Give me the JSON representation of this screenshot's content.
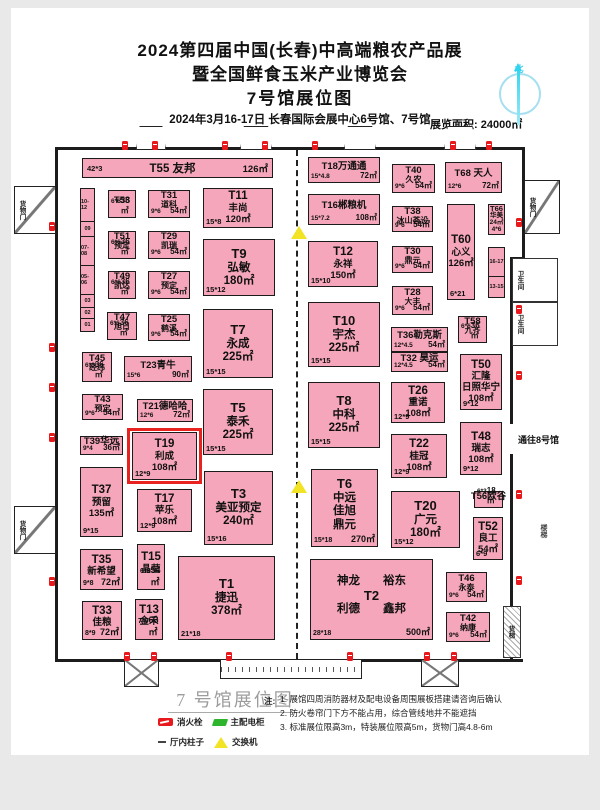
{
  "header": {
    "title1": "2024第四届中国(长春)中高端粮农产品展",
    "title2": "暨全国鲜食玉米产业博览会",
    "title3": "7号馆展位图",
    "date_line": "2024年3月16-17日  长春国际会展中心6号馆、7号馆",
    "area_label": "展览面积: 24000㎡"
  },
  "compass": {
    "north": "北"
  },
  "map": {
    "gate8": {
      "text": "通往8号馆",
      "x": 518,
      "y": 433
    },
    "side_label": {
      "text": "楼梯",
      "x": 538,
      "y": 524
    },
    "elevator": {
      "label": "货梯",
      "rect": [
        503,
        606,
        18,
        52
      ]
    },
    "booths": [
      {
        "id": "T55",
        "bar": true,
        "lines": [
          "T55  友邦"
        ],
        "bl": "42*3",
        "br": "126㎡",
        "rect": [
          82,
          158,
          191,
          20
        ]
      },
      {
        "id": "T53",
        "lines": [
          "T53"
        ],
        "bl": "6*6",
        "br": "36㎡",
        "rect": [
          108,
          190,
          28,
          28
        ]
      },
      {
        "id": "T31",
        "lines": [
          "T31",
          "道科"
        ],
        "bl": "9*6",
        "br": "54㎡",
        "rect": [
          148,
          190,
          42,
          28
        ]
      },
      {
        "id": "T11",
        "lines": [
          "T11",
          "丰尚",
          "120㎡"
        ],
        "bl": "15*8",
        "rect": [
          203,
          188,
          70,
          40
        ]
      },
      {
        "id": "T51",
        "lines": [
          "T51",
          "预定"
        ],
        "bl": "6*6",
        "br": "36㎡",
        "rect": [
          108,
          231,
          28,
          28
        ]
      },
      {
        "id": "T29",
        "lines": [
          "T29",
          "凯瑞"
        ],
        "bl": "9*6",
        "br": "54㎡",
        "rect": [
          148,
          231,
          42,
          28
        ]
      },
      {
        "id": "T9",
        "lines": [
          "T9",
          "弘敏",
          "180㎡"
        ],
        "bl": "15*12",
        "rect": [
          203,
          239,
          72,
          57
        ]
      },
      {
        "id": "T49",
        "lines": [
          "T49",
          "凯达"
        ],
        "bl": "6*6",
        "br": "36㎡",
        "rect": [
          108,
          271,
          28,
          28
        ]
      },
      {
        "id": "T27",
        "lines": [
          "T27",
          "预定"
        ],
        "bl": "9*6",
        "br": "54㎡",
        "rect": [
          148,
          271,
          42,
          28
        ]
      },
      {
        "id": "T47",
        "lines": [
          "T47",
          "旭日"
        ],
        "bl": "6*6",
        "br": "36㎡",
        "rect": [
          107,
          312,
          30,
          28
        ]
      },
      {
        "id": "T25",
        "lines": [
          "T25",
          "鹤溪"
        ],
        "bl": "9*6",
        "br": "54㎡",
        "rect": [
          148,
          314,
          42,
          27
        ]
      },
      {
        "id": "T7",
        "lines": [
          "T7",
          "永成",
          "225㎡"
        ],
        "bl": "15*15",
        "rect": [
          203,
          309,
          70,
          69
        ]
      },
      {
        "id": "T45",
        "lines": [
          "T45",
          "经纬"
        ],
        "bl": "6*6",
        "br": "36㎡",
        "rect": [
          82,
          352,
          30,
          30
        ]
      },
      {
        "id": "T23",
        "lines": [
          "T23青牛"
        ],
        "bl": "15*6",
        "br": "90㎡",
        "rect": [
          124,
          356,
          68,
          26
        ]
      },
      {
        "id": "T43",
        "lines": [
          "T43",
          "预定"
        ],
        "bl": "9*6",
        "br": "54㎡",
        "rect": [
          82,
          394,
          41,
          26
        ]
      },
      {
        "id": "T21",
        "lines": [
          "T21德哈哈"
        ],
        "bl": "12*6",
        "br": "72㎡",
        "rect": [
          137,
          399,
          56,
          23
        ]
      },
      {
        "id": "T5",
        "lines": [
          "T5",
          "泰禾",
          "225㎡"
        ],
        "bl": "15*15",
        "rect": [
          203,
          389,
          70,
          66
        ]
      },
      {
        "id": "T39",
        "lines": [
          "T39华远"
        ],
        "bl": "9*4",
        "br": "36㎡",
        "rect": [
          80,
          436,
          43,
          19
        ]
      },
      {
        "id": "T19",
        "hl": true,
        "lines": [
          "T19",
          "利成",
          "108㎡"
        ],
        "bl": "12*9",
        "rect": [
          132,
          432,
          65,
          48
        ]
      },
      {
        "id": "T37",
        "lines": [
          "T37",
          "预留",
          "135㎡"
        ],
        "bl": "9*15",
        "rect": [
          80,
          467,
          43,
          70
        ]
      },
      {
        "id": "T17",
        "lines": [
          "T17",
          "苹乐",
          "108㎡"
        ],
        "bl": "12*9",
        "rect": [
          137,
          489,
          55,
          43
        ]
      },
      {
        "id": "T3",
        "lines": [
          "T3",
          "美亚预定",
          "240㎡"
        ],
        "bl": "15*16",
        "rect": [
          204,
          471,
          69,
          74
        ]
      },
      {
        "id": "T35",
        "lines": [
          "T35",
          "新希望"
        ],
        "bl": "9*8",
        "br": "72㎡",
        "rect": [
          80,
          549,
          43,
          41
        ]
      },
      {
        "id": "T15",
        "lines": [
          "T15",
          "晶莹"
        ],
        "bl": "6*9",
        "br": "54㎡",
        "rect": [
          137,
          544,
          28,
          46
        ]
      },
      {
        "id": "T1",
        "lines": [
          "T1",
          "捷迅",
          "378㎡"
        ],
        "bl": "21*18",
        "rect": [
          178,
          556,
          97,
          84
        ]
      },
      {
        "id": "T33",
        "lines": [
          "T33",
          "佳粮"
        ],
        "bl": "8*9",
        "br": "72㎡",
        "rect": [
          82,
          601,
          40,
          39
        ]
      },
      {
        "id": "T13",
        "lines": [
          "T13",
          "金禾"
        ],
        "bl": "7*9",
        "br": "63㎡",
        "rect": [
          135,
          599,
          28,
          41
        ]
      },
      {
        "id": "T18",
        "lines": [
          "T18万通通"
        ],
        "bl": "15*4.8",
        "br": "72㎡",
        "rect": [
          308,
          157,
          72,
          26
        ]
      },
      {
        "id": "T40",
        "lines": [
          "T40",
          "久农"
        ],
        "bl": "9*6",
        "br": "54㎡",
        "rect": [
          392,
          164,
          43,
          29
        ]
      },
      {
        "id": "T68",
        "lines": [
          "T68 天人"
        ],
        "bl": "12*6",
        "br": "72㎡",
        "rect": [
          445,
          162,
          57,
          31
        ]
      },
      {
        "id": "T16",
        "lines": [
          "T16郴粮机"
        ],
        "bl": "15*7.2",
        "br": "108㎡",
        "rect": [
          308,
          194,
          72,
          31
        ]
      },
      {
        "id": "T38",
        "lines": [
          "T38",
          "冰山荟设"
        ],
        "bl": "9*6",
        "br": "54㎡",
        "rect": [
          392,
          206,
          41,
          26
        ]
      },
      {
        "id": "T66",
        "lines": [
          "T66",
          "华美",
          "24㎡",
          "4*6"
        ],
        "rect": [
          488,
          204,
          17,
          31
        ]
      },
      {
        "id": "T12",
        "lines": [
          "T12",
          "永祥",
          "150㎡"
        ],
        "bl": "15*10",
        "rect": [
          308,
          241,
          70,
          46
        ]
      },
      {
        "id": "T30",
        "lines": [
          "T30",
          "鼎元"
        ],
        "bl": "9*6",
        "br": "54㎡",
        "rect": [
          392,
          246,
          41,
          27
        ]
      },
      {
        "id": "T60",
        "lines": [
          "T60",
          "心义",
          "126㎡"
        ],
        "bl": "6*21",
        "rect": [
          447,
          204,
          28,
          96
        ]
      },
      {
        "id": "T28",
        "lines": [
          "T28",
          "大丰"
        ],
        "bl": "9*6",
        "br": "54㎡",
        "rect": [
          392,
          286,
          41,
          29
        ]
      },
      {
        "id": "T10",
        "lines": [
          "T10",
          "宇杰",
          "225㎡"
        ],
        "bl": "15*15",
        "rect": [
          308,
          302,
          72,
          65
        ]
      },
      {
        "id": "T36",
        "lines": [
          "T36勒克斯"
        ],
        "bl": "12*4.5",
        "br": "54㎡",
        "rect": [
          391,
          327,
          57,
          25
        ]
      },
      {
        "id": "T32",
        "lines": [
          "T32 昊运"
        ],
        "bl": "12*4.5",
        "br": "54㎡",
        "rect": [
          391,
          352,
          57,
          20
        ]
      },
      {
        "id": "T58",
        "lines": [
          "T58",
          "九齐"
        ],
        "bl": "6*6",
        "br": "36㎡",
        "rect": [
          458,
          316,
          29,
          27
        ]
      },
      {
        "id": "T50",
        "lines": [
          "T50",
          "汇隆",
          "日照华宁",
          "108㎡"
        ],
        "bl": "9*12",
        "rect": [
          460,
          354,
          42,
          56
        ]
      },
      {
        "id": "T26",
        "lines": [
          "T26",
          "重诺",
          "108㎡"
        ],
        "bl": "12*9",
        "rect": [
          391,
          382,
          54,
          41
        ]
      },
      {
        "id": "T8",
        "lines": [
          "T8",
          "中科",
          "225㎡"
        ],
        "bl": "15*15",
        "rect": [
          308,
          382,
          72,
          66
        ]
      },
      {
        "id": "T22",
        "lines": [
          "T22",
          "桂冠",
          "108㎡"
        ],
        "bl": "12*9",
        "rect": [
          391,
          434,
          56,
          44
        ]
      },
      {
        "id": "T48",
        "lines": [
          "T48",
          "瑞志",
          "108㎡"
        ],
        "bl": "9*12",
        "rect": [
          460,
          422,
          42,
          53
        ]
      },
      {
        "id": "T6",
        "lines": [
          "T6",
          "中远",
          "佳旭",
          "鼎元"
        ],
        "bl": "15*18",
        "br": "270㎡",
        "rect": [
          311,
          469,
          67,
          78
        ]
      },
      {
        "id": "T20",
        "lines": [
          "T20",
          "广元",
          "180㎡"
        ],
        "bl": "15*12",
        "rect": [
          391,
          491,
          69,
          57
        ]
      },
      {
        "id": "T56",
        "lines": [
          "T56欧谷"
        ],
        "bl": "6*3",
        "br": "18㎡",
        "rect": [
          474,
          491,
          29,
          17
        ]
      },
      {
        "id": "T52",
        "lines": [
          "T52",
          "良工",
          "54㎡"
        ],
        "bl": "6*9",
        "rect": [
          473,
          517,
          30,
          43
        ]
      },
      {
        "id": "T2",
        "lines": [
          "神龙　　裕东",
          "T2",
          "利德　　鑫邦"
        ],
        "bl": "28*18",
        "br": "500㎡",
        "rect": [
          310,
          559,
          123,
          81
        ]
      },
      {
        "id": "T46",
        "lines": [
          "T46",
          "永泰"
        ],
        "bl": "9*6",
        "br": "54㎡",
        "rect": [
          446,
          572,
          41,
          30
        ]
      },
      {
        "id": "T42",
        "lines": [
          "T42",
          "纳康"
        ],
        "bl": "9*6",
        "br": "54㎡",
        "rect": [
          446,
          612,
          44,
          30
        ]
      }
    ],
    "strips": [
      {
        "x": 80,
        "y": 188,
        "w": 15,
        "segs": [
          [
            "10-12",
            34
          ],
          [
            "09",
            16
          ],
          [
            "07-08",
            30
          ],
          [
            "05-06",
            30
          ],
          [
            "03",
            14
          ],
          [
            "02",
            12
          ],
          [
            "01",
            14
          ]
        ]
      },
      {
        "x": 488,
        "y": 247,
        "w": 17,
        "segs": [
          [
            "16-17",
            30
          ],
          [
            "13-15",
            22
          ]
        ]
      }
    ],
    "doors": [
      {
        "label": "货物门",
        "rect": [
          14,
          186,
          42,
          48
        ]
      },
      {
        "label": "货物门",
        "rect": [
          14,
          506,
          42,
          48
        ]
      },
      {
        "label": "货物门",
        "rect": [
          524,
          180,
          36,
          54
        ]
      }
    ],
    "rooms": [
      {
        "label": "卫生间",
        "rect": [
          512,
          258,
          46,
          44
        ]
      },
      {
        "label": "卫生间",
        "rect": [
          512,
          302,
          46,
          44
        ]
      }
    ],
    "canopies": [
      [
        136,
        126,
        30,
        24
      ],
      [
        240,
        126,
        32,
        24
      ],
      [
        344,
        126,
        32,
        24
      ],
      [
        444,
        126,
        32,
        24
      ]
    ],
    "bottom_vestibules": [
      [
        124,
        659,
        35,
        28
      ],
      [
        421,
        659,
        38,
        28
      ]
    ],
    "zigzag": [
      220,
      659,
      142,
      20
    ],
    "hydrants": [
      [
        122,
        141
      ],
      [
        152,
        141
      ],
      [
        222,
        141
      ],
      [
        262,
        141
      ],
      [
        312,
        141
      ],
      [
        450,
        141
      ],
      [
        486,
        141
      ],
      [
        49,
        222
      ],
      [
        49,
        343
      ],
      [
        49,
        383
      ],
      [
        49,
        433
      ],
      [
        49,
        577
      ],
      [
        516,
        218
      ],
      [
        516,
        305
      ],
      [
        516,
        371
      ],
      [
        516,
        490
      ],
      [
        516,
        576
      ],
      [
        124,
        652
      ],
      [
        151,
        652
      ],
      [
        226,
        652
      ],
      [
        347,
        652
      ],
      [
        424,
        652
      ],
      [
        451,
        652
      ]
    ],
    "switches": [
      [
        291,
        226
      ],
      [
        291,
        480
      ]
    ]
  },
  "footer": {
    "map_title": "7 号馆展位图",
    "legend": [
      {
        "icon": "fire-hydrant-icon",
        "label": "消火栓"
      },
      {
        "icon": "power-cabinet-icon",
        "label": "主配电柜"
      },
      {
        "icon": "column-icon",
        "label": "厅内柱子"
      },
      {
        "icon": "switch-icon",
        "label": "交换机"
      }
    ],
    "notes_label": "注:",
    "notes": [
      "1. 展馆四周消防器材及配电设备周围展板搭建请咨询后确认",
      "2. 防火卷帘门下方不能占用，综合管线地井不能遮挡",
      "3. 标准展位限高3m，特装展位限高5m，货物门高4.8-6m"
    ]
  }
}
